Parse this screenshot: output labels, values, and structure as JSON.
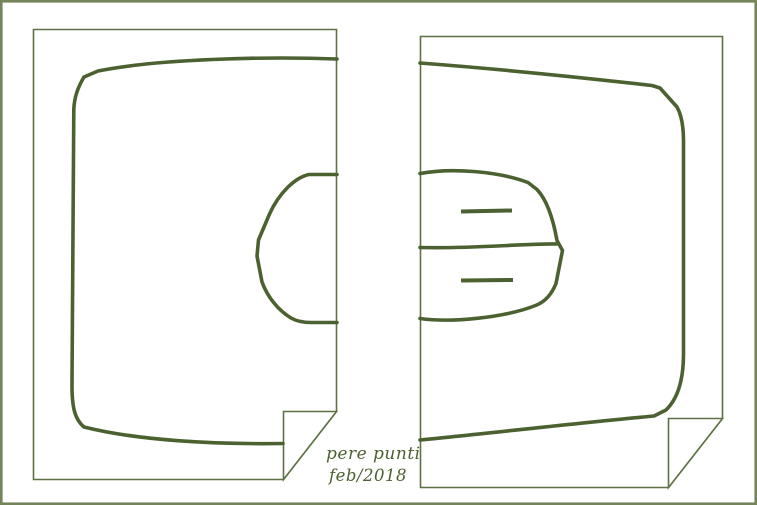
{
  "signature": {
    "line1": "pere punti",
    "line2": "feb/2018"
  },
  "colors": {
    "ink": "#4c6130",
    "page_border": "#5e7145",
    "frame_border": "#74855b",
    "background": "#ffffff",
    "signature_ink": "#4c6130"
  }
}
